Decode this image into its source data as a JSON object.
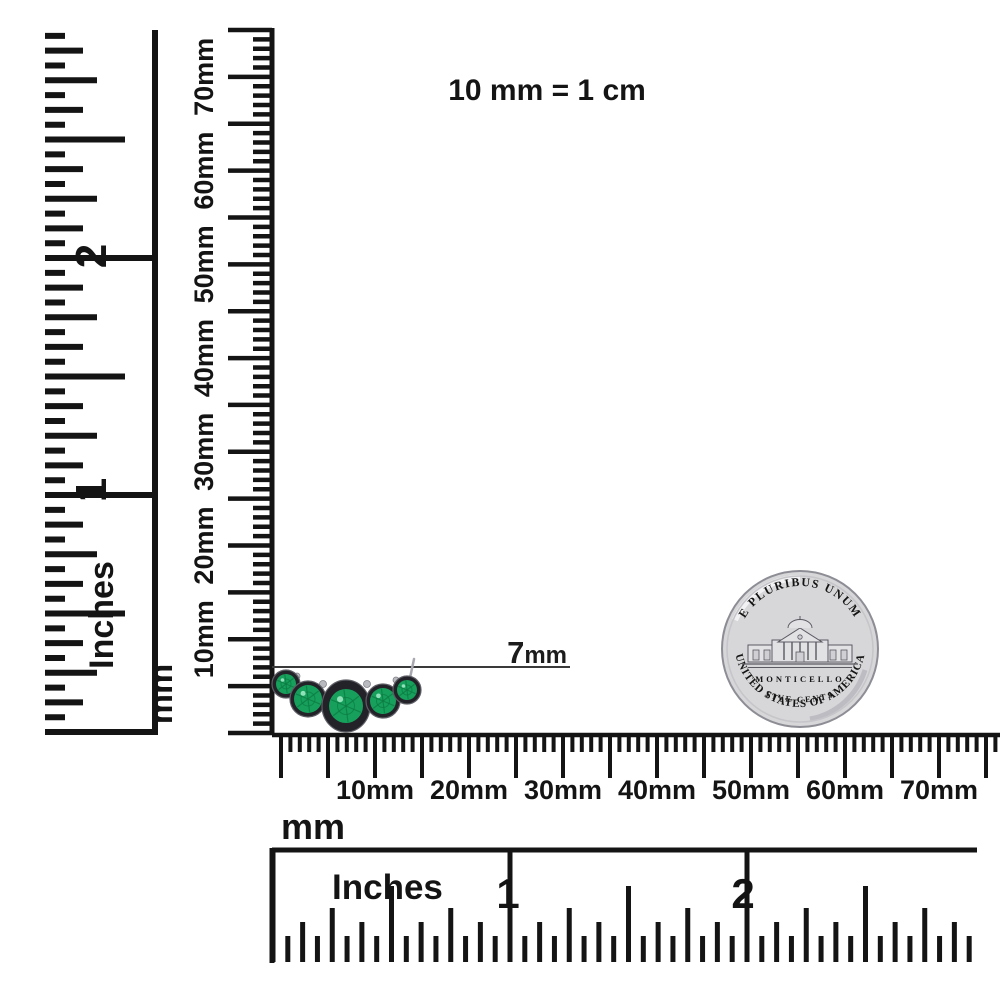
{
  "scale_note": "10 mm = 1 cm",
  "annotation": {
    "value": "7",
    "unit": "mm"
  },
  "left_inch_ruler": {
    "unit_label": "Inches",
    "numbers": [
      "1",
      "2"
    ]
  },
  "left_mm_ruler": {
    "unit_label": "mm",
    "labels": [
      "10mm",
      "20mm",
      "30mm",
      "40mm",
      "50mm",
      "60mm",
      "70mm"
    ]
  },
  "bottom_mm_ruler": {
    "unit_label": "mm",
    "labels": [
      "10mm",
      "20mm",
      "30mm",
      "40mm",
      "50mm",
      "60mm",
      "70mm"
    ]
  },
  "bottom_inch_ruler": {
    "unit_label": "Inches",
    "numbers": [
      "1",
      "2"
    ]
  },
  "coin": {
    "top_text": "E PLURIBUS UNUM",
    "building_name": "MONTICELLO",
    "denomination_text": "FIVE CENTS",
    "bottom_text": "UNITED STATES OF AMERICA"
  },
  "jewelry": {
    "stone_count": 5,
    "description": "curved bar of five round bezel-set emeralds"
  },
  "colors": {
    "background": "#ffffff",
    "ink": "#141414",
    "annotation_line": "#3a3a3a",
    "emerald": "#16a05c",
    "emerald_dark": "#0c7a42",
    "emerald_light": "#9fe8c3",
    "bezel": "#222228",
    "bezel_edge": "#5e5e66",
    "silver": "#b9b9c0",
    "coin_face": "#d7d7d9",
    "coin_rim": "#8d8d95",
    "coin_highlight": "#f0f0f2",
    "coin_shadow": "#bcbcc2",
    "coin_engraving": "#5a5a62"
  }
}
